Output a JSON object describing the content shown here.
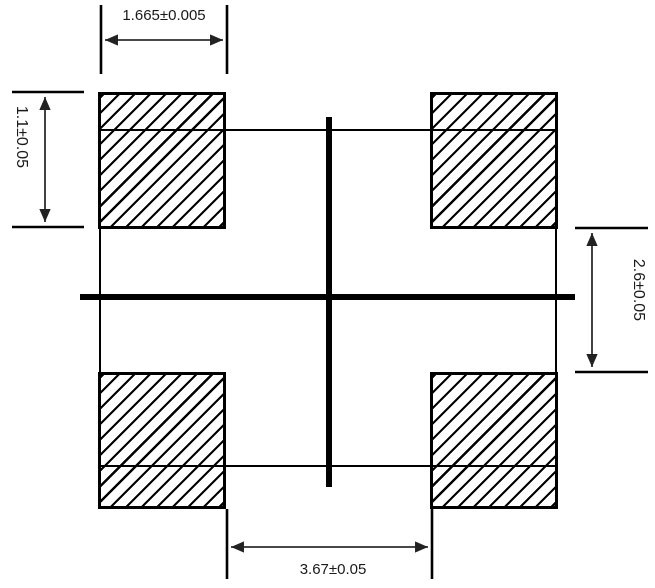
{
  "drawing": {
    "pads": [
      {
        "position": "top-left"
      },
      {
        "position": "top-right"
      },
      {
        "position": "bottom-left"
      },
      {
        "position": "bottom-right"
      }
    ],
    "dims": {
      "pad_width": "1.665±0.005",
      "pad_height": "1.1±0.05",
      "row_gap": "2.6±0.05",
      "inner_span": "3.67±0.05"
    },
    "colors": {
      "background": "#ffffff",
      "outline": "#000000",
      "centerline": "#000000",
      "dimension_line": "#2e2e2e",
      "text": "#1a1a1a"
    }
  }
}
